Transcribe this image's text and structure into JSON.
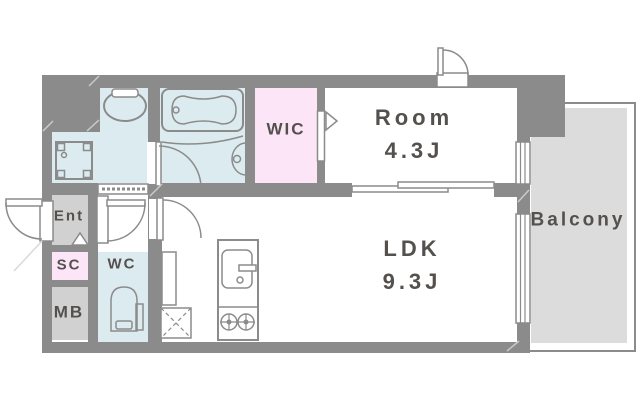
{
  "floorplan": {
    "rooms": {
      "room": {
        "label": "Room",
        "size": "4.3J"
      },
      "ldk": {
        "label": "LDK",
        "size": "9.3J"
      },
      "wic": {
        "label": "WIC"
      },
      "balcony": {
        "label": "Balcony"
      },
      "entrance": {
        "label": "Ent"
      },
      "shoe_closet": {
        "label": "SC"
      },
      "water_closet": {
        "label": "WC"
      },
      "meter_box": {
        "label": "MB"
      }
    },
    "colors": {
      "background": "#ffffff",
      "wall": "#8b8b8b",
      "wet_area": "#dcebf0",
      "closet_pink": "#fbe5f7",
      "service_gray": "#d2d1d1",
      "balcony_fill": "#dcdcdc",
      "label_text": "#54504e"
    }
  }
}
